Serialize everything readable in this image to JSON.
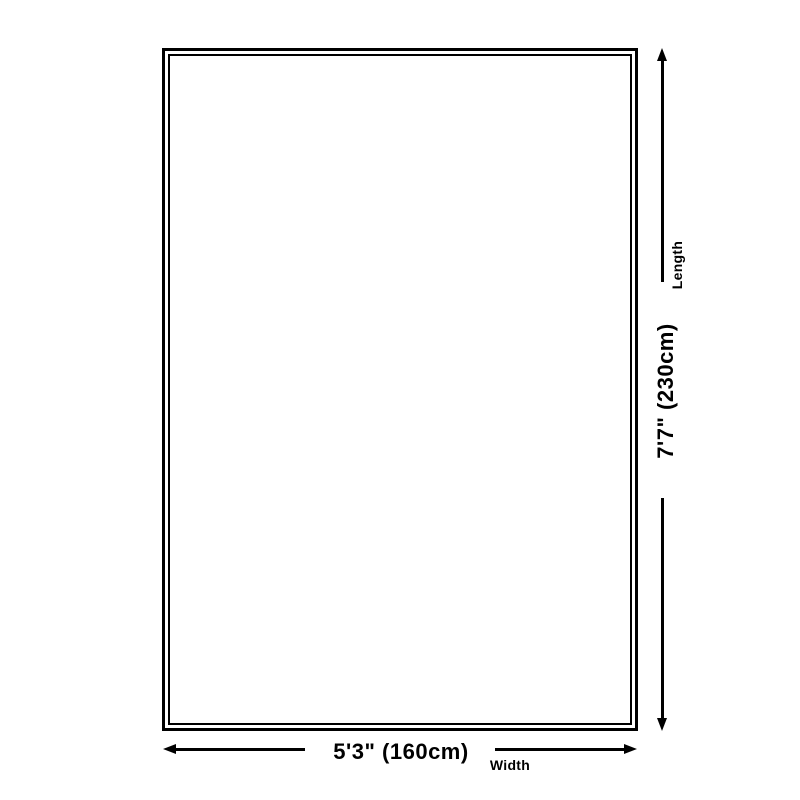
{
  "diagram": {
    "type": "rug-size-dimension-diagram",
    "background_color": "#ffffff",
    "line_color": "#000000",
    "length": {
      "value": "7'7\" (230cm)",
      "caption": "Length"
    },
    "width": {
      "value": "5'3\" (160cm)",
      "caption": "Width"
    }
  }
}
